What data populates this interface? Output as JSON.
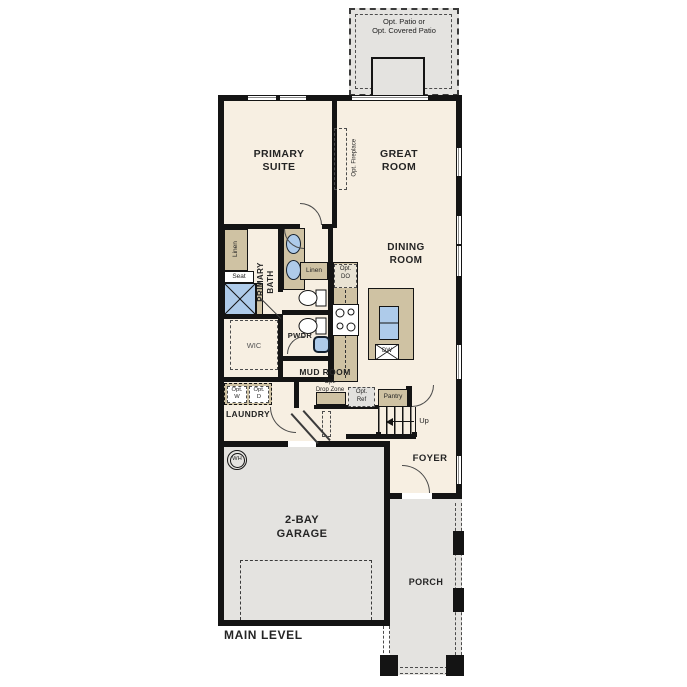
{
  "plan": {
    "level_label": "MAIN LEVEL"
  },
  "rooms": {
    "primary_suite": "PRIMARY\nSUITE",
    "great_room": "GREAT\nROOM",
    "dining_room": "DINING\nROOM",
    "primary_bath": "PRIMARY\nBATH",
    "wic": "WIC",
    "pwdr": "PWDR",
    "mud_room": "MUD ROOM",
    "laundry": "LAUNDRY",
    "foyer": "FOYER",
    "garage": "2-BAY\nGARAGE",
    "porch": "PORCH",
    "pantry": "Pantry"
  },
  "annotations": {
    "opt_patio": "Opt. Patio or\nOpt. Covered Patio",
    "opt_fireplace": "Opt. Fireplace",
    "linen_bath": "Linen",
    "linen_hall": "Linen",
    "seat": "Seat",
    "opt_do": "Opt.\nDO",
    "opt_drop_zone": "Opt.\nDrop Zone",
    "opt_ref": "Opt.\nRef",
    "opt_washer": "Opt.\nW",
    "opt_dryer": "Opt.\nD",
    "up": "Up",
    "dishwasher": "DW",
    "water_heater": "WH"
  },
  "colors": {
    "floor": "#f7efe2",
    "concrete": "#e4e3e0",
    "cabinet": "#cfc2a3",
    "fixture_blue": "#aecbea",
    "wall": "#141414"
  }
}
